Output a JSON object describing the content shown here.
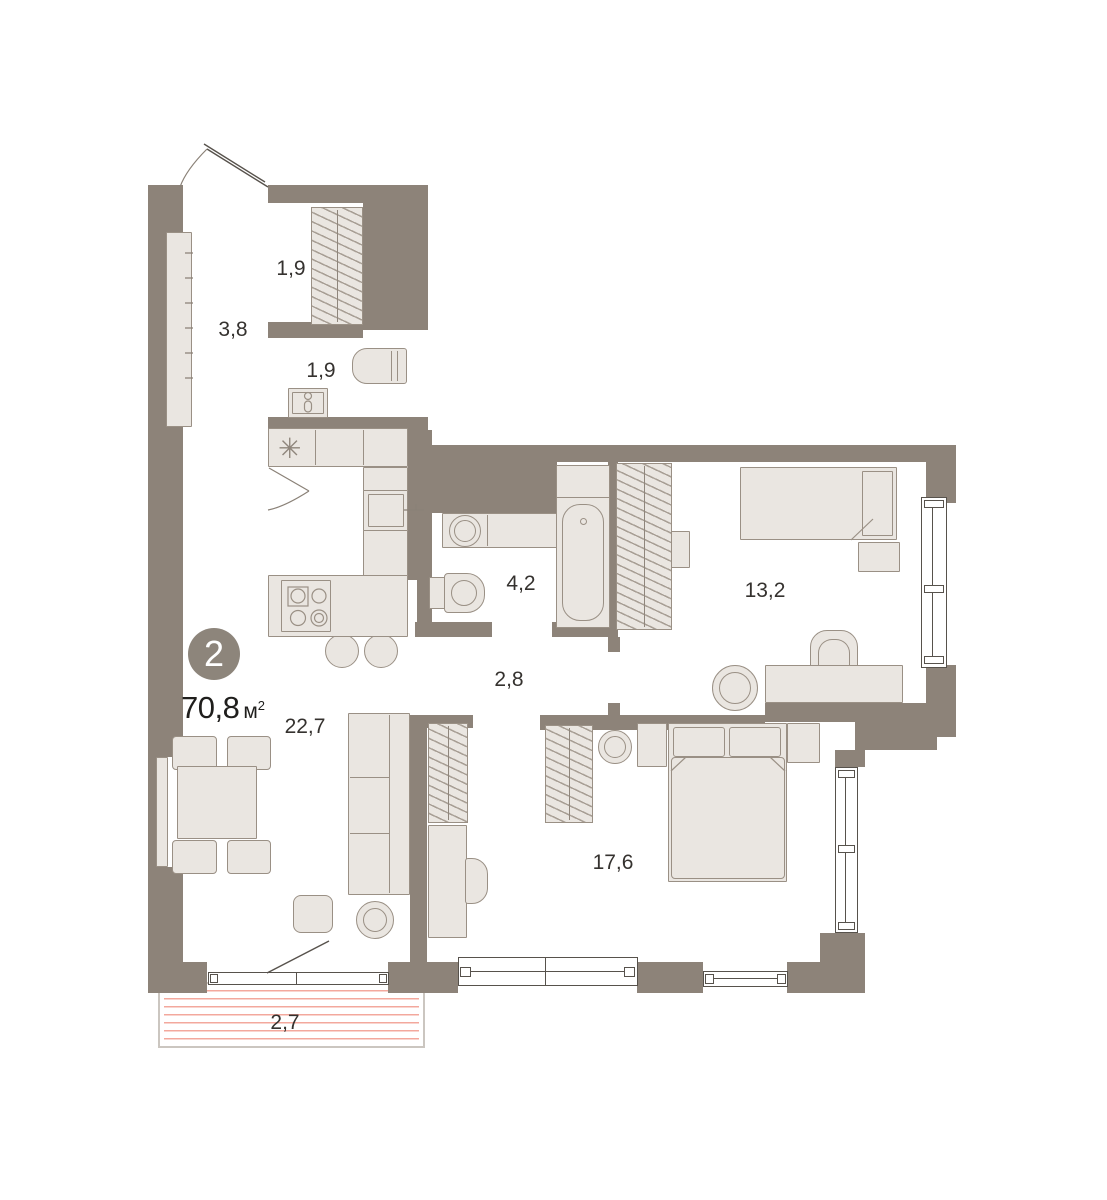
{
  "plan": {
    "badge_rooms": "2",
    "total_area": "70,8",
    "area_unit_base": "м",
    "area_unit_sup": "2",
    "rooms": {
      "hallway": "3,8",
      "closet": "1,9",
      "wc": "1,9",
      "bathroom": "4,2",
      "corridor": "2,8",
      "bedroom_small": "13,2",
      "living": "22,7",
      "bedroom_large": "17,6",
      "balcony": "2,7"
    },
    "fridge_symbol": "✳",
    "colors": {
      "wall": "#8d8379",
      "furniture": "#eae6e1",
      "furniture_border": "#9a9085",
      "window_frame": "#57524c",
      "balcony_stripe": "#f3a89d",
      "badge": "#8d857b",
      "label_text": "#35322f"
    }
  }
}
